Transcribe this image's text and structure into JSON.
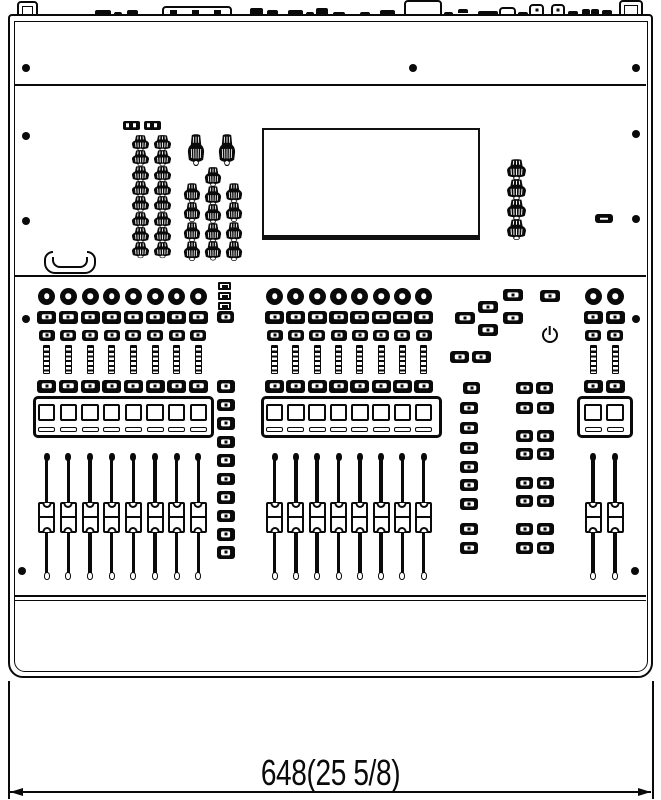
{
  "drawing": {
    "type": "technical-dimension-drawing",
    "subject": "digital mixing console front panel",
    "dimension_label": "648(25 5/8)",
    "dimension_millimeters": "648",
    "dimension_inches": "25 5/8"
  },
  "panel": {
    "upper_section": {
      "led_blocks": 2,
      "small_knob_columns": [
        8,
        8
      ],
      "large_knob_top_row": 2,
      "large_knob_columns": [
        4,
        5,
        4
      ],
      "display_screen": "blank rectangle",
      "right_knob_column": 4,
      "usb_ports": 1,
      "handle_recesses": 1
    },
    "channel_banks": [
      {
        "name": "left-input-bank",
        "strips": 8
      },
      {
        "name": "center-input-bank",
        "strips": 8
      },
      {
        "name": "master-bank",
        "strips": 2
      }
    ],
    "strip_controls": [
      "encoder",
      "select-button",
      "solo-button",
      "level-meter",
      "mute-button",
      "scribble-display",
      "fader"
    ],
    "right_controls": {
      "indicator_leds": 3,
      "view_button_column": 10,
      "navigation_buttons": 5,
      "utility_buttons": 6,
      "assign_grid_left_column": 8,
      "assign_grid_pair_rows": 7,
      "power_symbol": "standby"
    },
    "visible_screws": 11
  },
  "colors": {
    "line": "#000000",
    "paper": "#ffffff"
  }
}
